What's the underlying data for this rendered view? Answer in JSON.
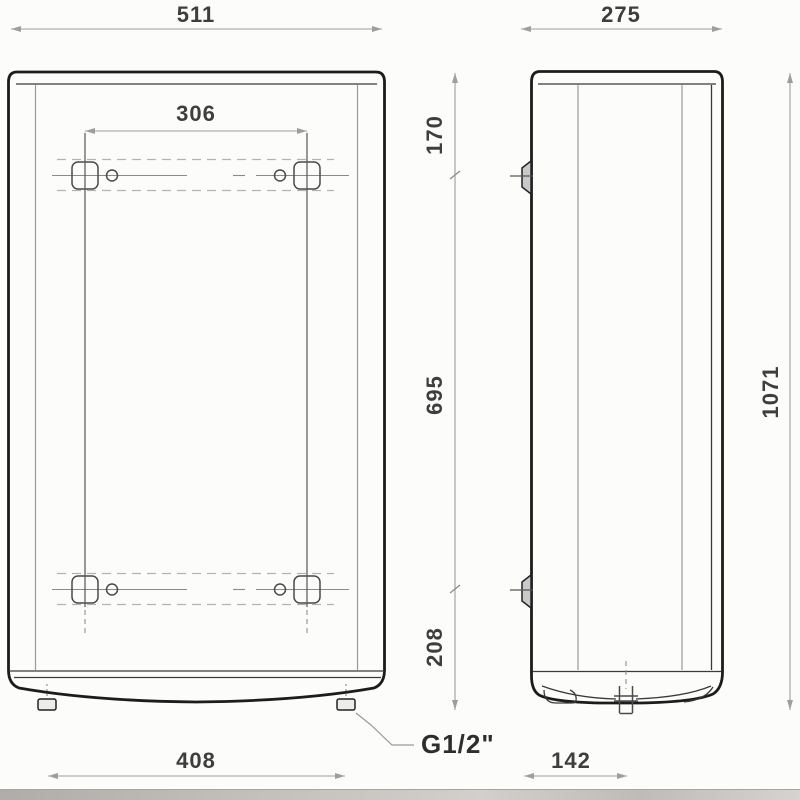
{
  "diagram": {
    "type": "technical-dimension-drawing",
    "views": {
      "front": "front-view",
      "side": "side-view"
    },
    "dimensions": {
      "front_width": "511",
      "bracket_spacing": "306",
      "top_to_bracket": "170",
      "bracket_span": "695",
      "bracket_to_bottom": "208",
      "total_height": "1071",
      "side_depth": "275",
      "connection_spacing": "408",
      "bottom_depth": "142",
      "connection_thread": "G1/2\""
    },
    "colors": {
      "outline": "#1c1c1c",
      "thin": "#9a9a9a",
      "dim": "#9e9e9e",
      "dashed": "#b3b3b3",
      "text": "#3e3e3e",
      "background": "#fcfcfb",
      "strip": "#c2beba"
    }
  }
}
